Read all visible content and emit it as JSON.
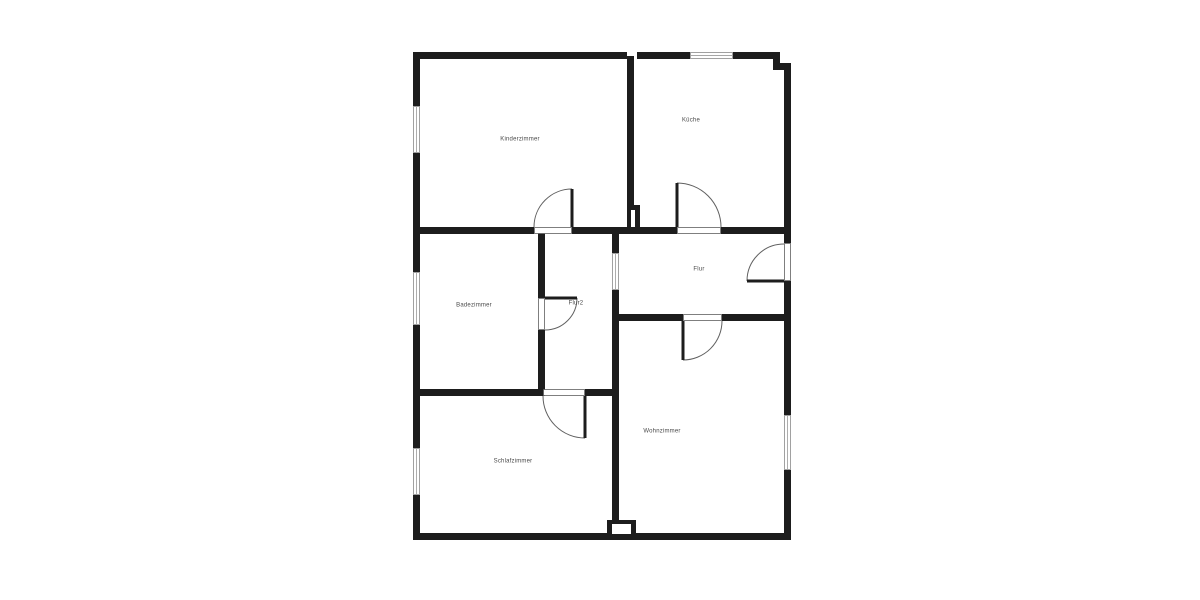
{
  "plan": {
    "title": "floor-plan",
    "canvas": {
      "width": 1200,
      "height": 600,
      "background": "#ffffff"
    },
    "colors": {
      "wall": "#1d1d1d",
      "label": "#4a4a4a",
      "arc": "#606060",
      "frame_border": "#606060",
      "window_border": "#8a8a8a",
      "white": "#ffffff"
    },
    "rooms": [
      {
        "key": "kinderzimmer",
        "label": "Kinderzimmer",
        "x": 520,
        "y": 139
      },
      {
        "key": "kueche",
        "label": "Küche",
        "x": 691,
        "y": 120
      },
      {
        "key": "badezimmer",
        "label": "Badezimmer",
        "x": 474,
        "y": 305
      },
      {
        "key": "flur2",
        "label": "Flur2",
        "x": 576,
        "y": 303
      },
      {
        "key": "flur",
        "label": "Flur",
        "x": 699,
        "y": 269
      },
      {
        "key": "schlafzimmer",
        "label": "Schlafzimmer",
        "x": 513,
        "y": 461
      },
      {
        "key": "wohnzimmer",
        "label": "Wohnzimmer",
        "x": 662,
        "y": 431
      }
    ],
    "walls": [
      {
        "x": 413,
        "y": 52,
        "w": 214,
        "h": 7
      },
      {
        "x": 637,
        "y": 52,
        "w": 53,
        "h": 7
      },
      {
        "x": 733,
        "y": 52,
        "w": 47,
        "h": 7
      },
      {
        "x": 773,
        "y": 52,
        "w": 7,
        "h": 18
      },
      {
        "x": 773,
        "y": 63,
        "w": 18,
        "h": 7
      },
      {
        "x": 413,
        "y": 227,
        "w": 121,
        "h": 7
      },
      {
        "x": 572,
        "y": 227,
        "w": 105,
        "h": 7
      },
      {
        "x": 721,
        "y": 227,
        "w": 70,
        "h": 7
      },
      {
        "x": 612,
        "y": 314,
        "w": 71,
        "h": 7
      },
      {
        "x": 722,
        "y": 314,
        "w": 69,
        "h": 7
      },
      {
        "x": 413,
        "y": 389,
        "w": 130,
        "h": 7
      },
      {
        "x": 585,
        "y": 389,
        "w": 34,
        "h": 7
      },
      {
        "x": 413,
        "y": 533,
        "w": 378,
        "h": 7
      },
      {
        "x": 413,
        "y": 52,
        "w": 7,
        "h": 54
      },
      {
        "x": 413,
        "y": 153,
        "w": 7,
        "h": 119
      },
      {
        "x": 413,
        "y": 325,
        "w": 7,
        "h": 123
      },
      {
        "x": 413,
        "y": 495,
        "w": 7,
        "h": 45
      },
      {
        "x": 784,
        "y": 63,
        "w": 7,
        "h": 180
      },
      {
        "x": 784,
        "y": 281,
        "w": 7,
        "h": 134
      },
      {
        "x": 784,
        "y": 470,
        "w": 7,
        "h": 70
      },
      {
        "x": 627,
        "y": 52,
        "w": 7,
        "h": 160
      },
      {
        "x": 627,
        "y": 205,
        "w": 13,
        "h": 27
      },
      {
        "x": 538,
        "y": 230,
        "w": 7,
        "h": 68
      },
      {
        "x": 538,
        "y": 330,
        "w": 7,
        "h": 66
      },
      {
        "x": 612,
        "y": 227,
        "w": 7,
        "h": 26
      },
      {
        "x": 612,
        "y": 290,
        "w": 7,
        "h": 231
      },
      {
        "x": 607,
        "y": 520,
        "w": 29,
        "h": 14
      }
    ],
    "white_patches": [
      {
        "x": 631,
        "y": 210,
        "w": 4,
        "h": 17
      },
      {
        "x": 627,
        "y": 52,
        "w": 8,
        "h": 4
      },
      {
        "x": 612,
        "y": 524,
        "w": 19,
        "h": 10
      }
    ],
    "windows": [
      {
        "key": "window-kinderzimmer-left",
        "x": 413,
        "y": 106,
        "w": 7,
        "h": 47
      },
      {
        "key": "window-badezimmer-left",
        "x": 413,
        "y": 272,
        "w": 7,
        "h": 53
      },
      {
        "key": "window-schlafzimmer-left",
        "x": 413,
        "y": 448,
        "w": 7,
        "h": 47
      },
      {
        "key": "window-kueche-top",
        "x": 690,
        "y": 52,
        "w": 43,
        "h": 7
      },
      {
        "key": "window-wohnzimmer-right",
        "x": 784,
        "y": 415,
        "w": 7,
        "h": 55
      },
      {
        "key": "window-flur2-flur",
        "x": 612,
        "y": 253,
        "w": 7,
        "h": 37
      }
    ],
    "door_frames": [
      {
        "key": "frame-kinderzimmer",
        "x": 534,
        "y": 227,
        "w": 38,
        "h": 7
      },
      {
        "key": "frame-kueche",
        "x": 677,
        "y": 227,
        "w": 44,
        "h": 7
      },
      {
        "key": "frame-wohnzimmer",
        "x": 683,
        "y": 314,
        "w": 39,
        "h": 7
      },
      {
        "key": "frame-flur2",
        "x": 538,
        "y": 298,
        "w": 7,
        "h": 32
      },
      {
        "key": "frame-schlafzimmer",
        "x": 543,
        "y": 389,
        "w": 42,
        "h": 7
      },
      {
        "key": "frame-entrance",
        "x": 784,
        "y": 243,
        "w": 7,
        "h": 38
      }
    ],
    "doors": [
      {
        "key": "door-kinderzimmer",
        "leaf": "M572 227 L572 189",
        "arc": "M572 189 A38 38 0 0 0 534 227"
      },
      {
        "key": "door-kueche",
        "leaf": "M677 227 L677 183",
        "arc": "M677 183 A44 44 0 0 1 721 227"
      },
      {
        "key": "door-wohnzimmer",
        "leaf": "M683 321 L683 360",
        "arc": "M683 360 A39 39 0 0 0 722 321"
      },
      {
        "key": "door-flur2",
        "leaf": "M545 298 L577 298",
        "arc": "M577 298 A32 32 0 0 1 545 330"
      },
      {
        "key": "door-schlafzimmer",
        "leaf": "M585 396 L585 438",
        "arc": "M585 438 A42 42 0 0 1 543 396"
      },
      {
        "key": "door-entrance",
        "leaf": "M784 281 L747 281",
        "arc": "M747 281 A37 37 0 0 1 784 244"
      }
    ]
  }
}
